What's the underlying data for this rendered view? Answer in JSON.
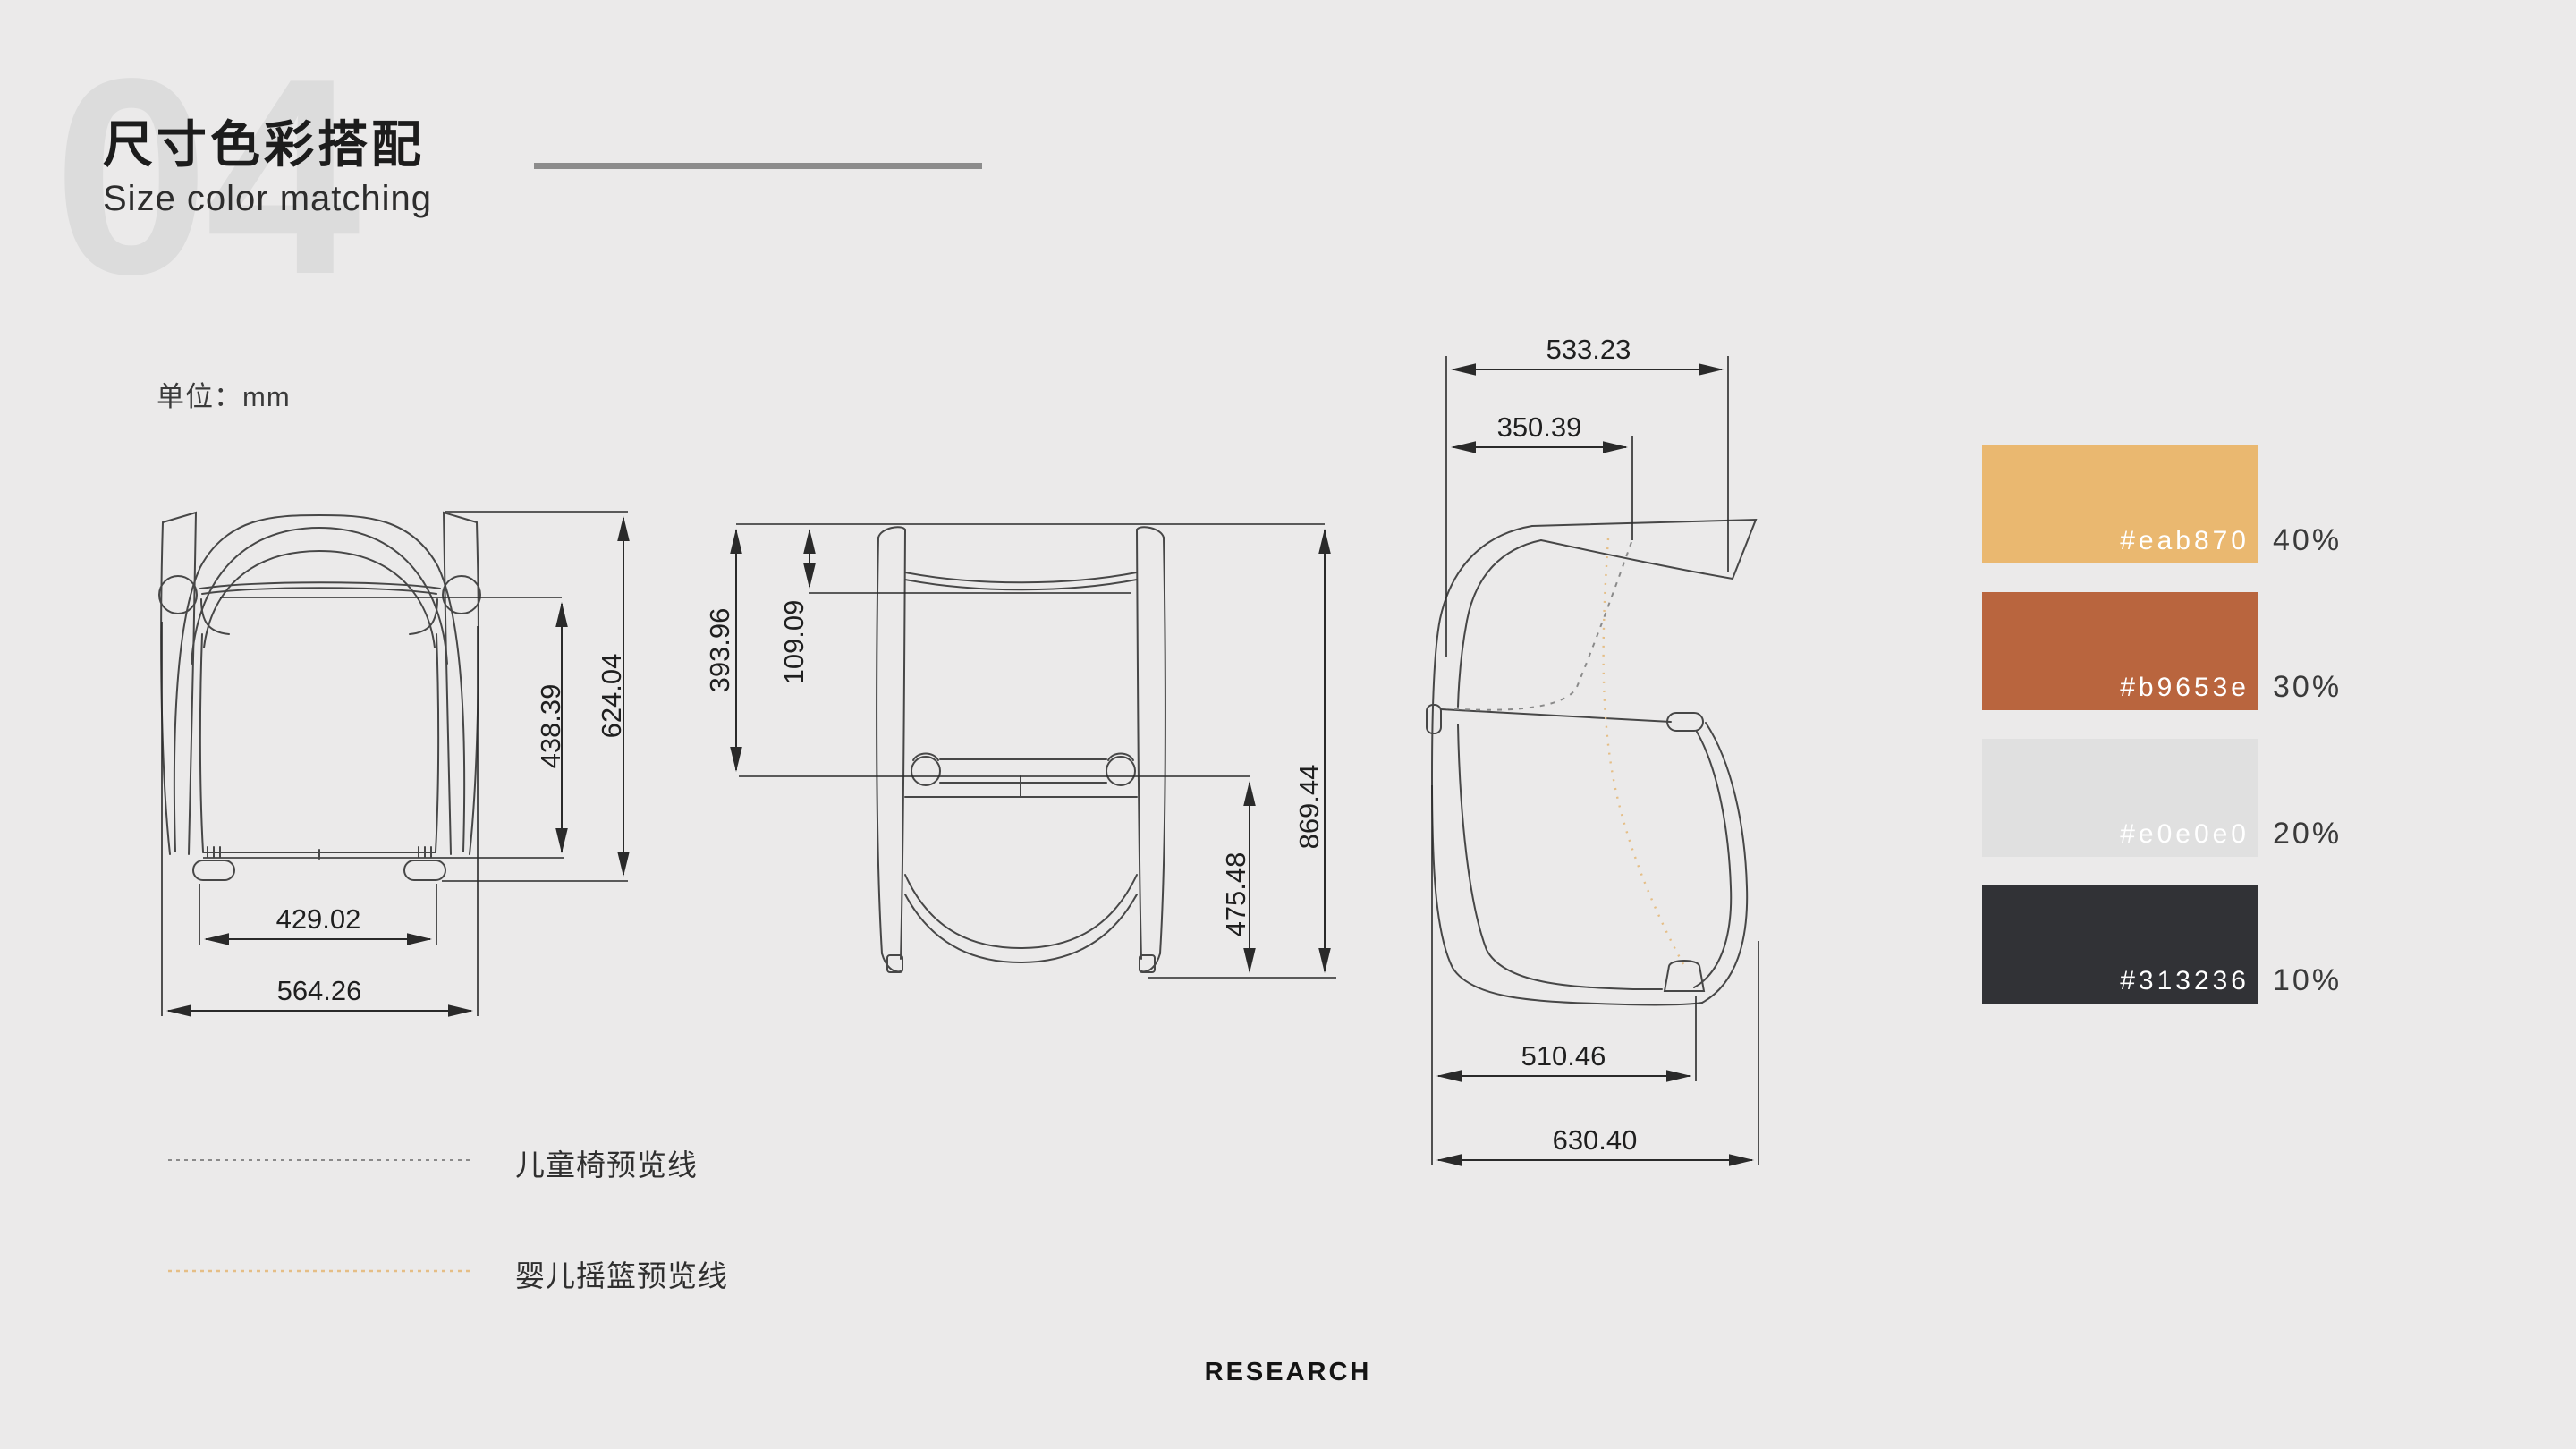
{
  "slide": {
    "section_number": "04",
    "title": "尺寸色彩搭配",
    "subtitle": "Size color matching",
    "unit_label": "单位：mm",
    "footer": "RESEARCH"
  },
  "views": {
    "front": {
      "name": "front-view",
      "dims": {
        "total_height": "624.04",
        "back_height": "438.39",
        "inner_width": "429.02",
        "total_width": "564.26"
      }
    },
    "back": {
      "name": "back-view",
      "dims": {
        "frame_top": "393.96",
        "headrest_gap": "109.09",
        "under_seat": "475.48",
        "total_height": "869.44"
      }
    },
    "side": {
      "name": "side-view",
      "dims": {
        "top_width": "533.23",
        "backrest_width": "350.39",
        "base_width": "510.46",
        "total_width": "630.40"
      }
    }
  },
  "legend": [
    {
      "label": "儿童椅预览线",
      "color": "#8a8a8a",
      "style": "dashed"
    },
    {
      "label": "婴儿摇篮预览线",
      "color": "#e5be86",
      "style": "dashed"
    }
  ],
  "palette": [
    {
      "hex": "#eab870",
      "percent": "40%"
    },
    {
      "hex": "#b9653e",
      "percent": "30%"
    },
    {
      "hex": "#e0e0e0",
      "percent": "20%"
    },
    {
      "hex": "#313236",
      "percent": "10%"
    }
  ],
  "colors": {
    "background": "#ebeaea",
    "accent_line": "#8c8c8c",
    "number_watermark": "#dcdcdc"
  }
}
